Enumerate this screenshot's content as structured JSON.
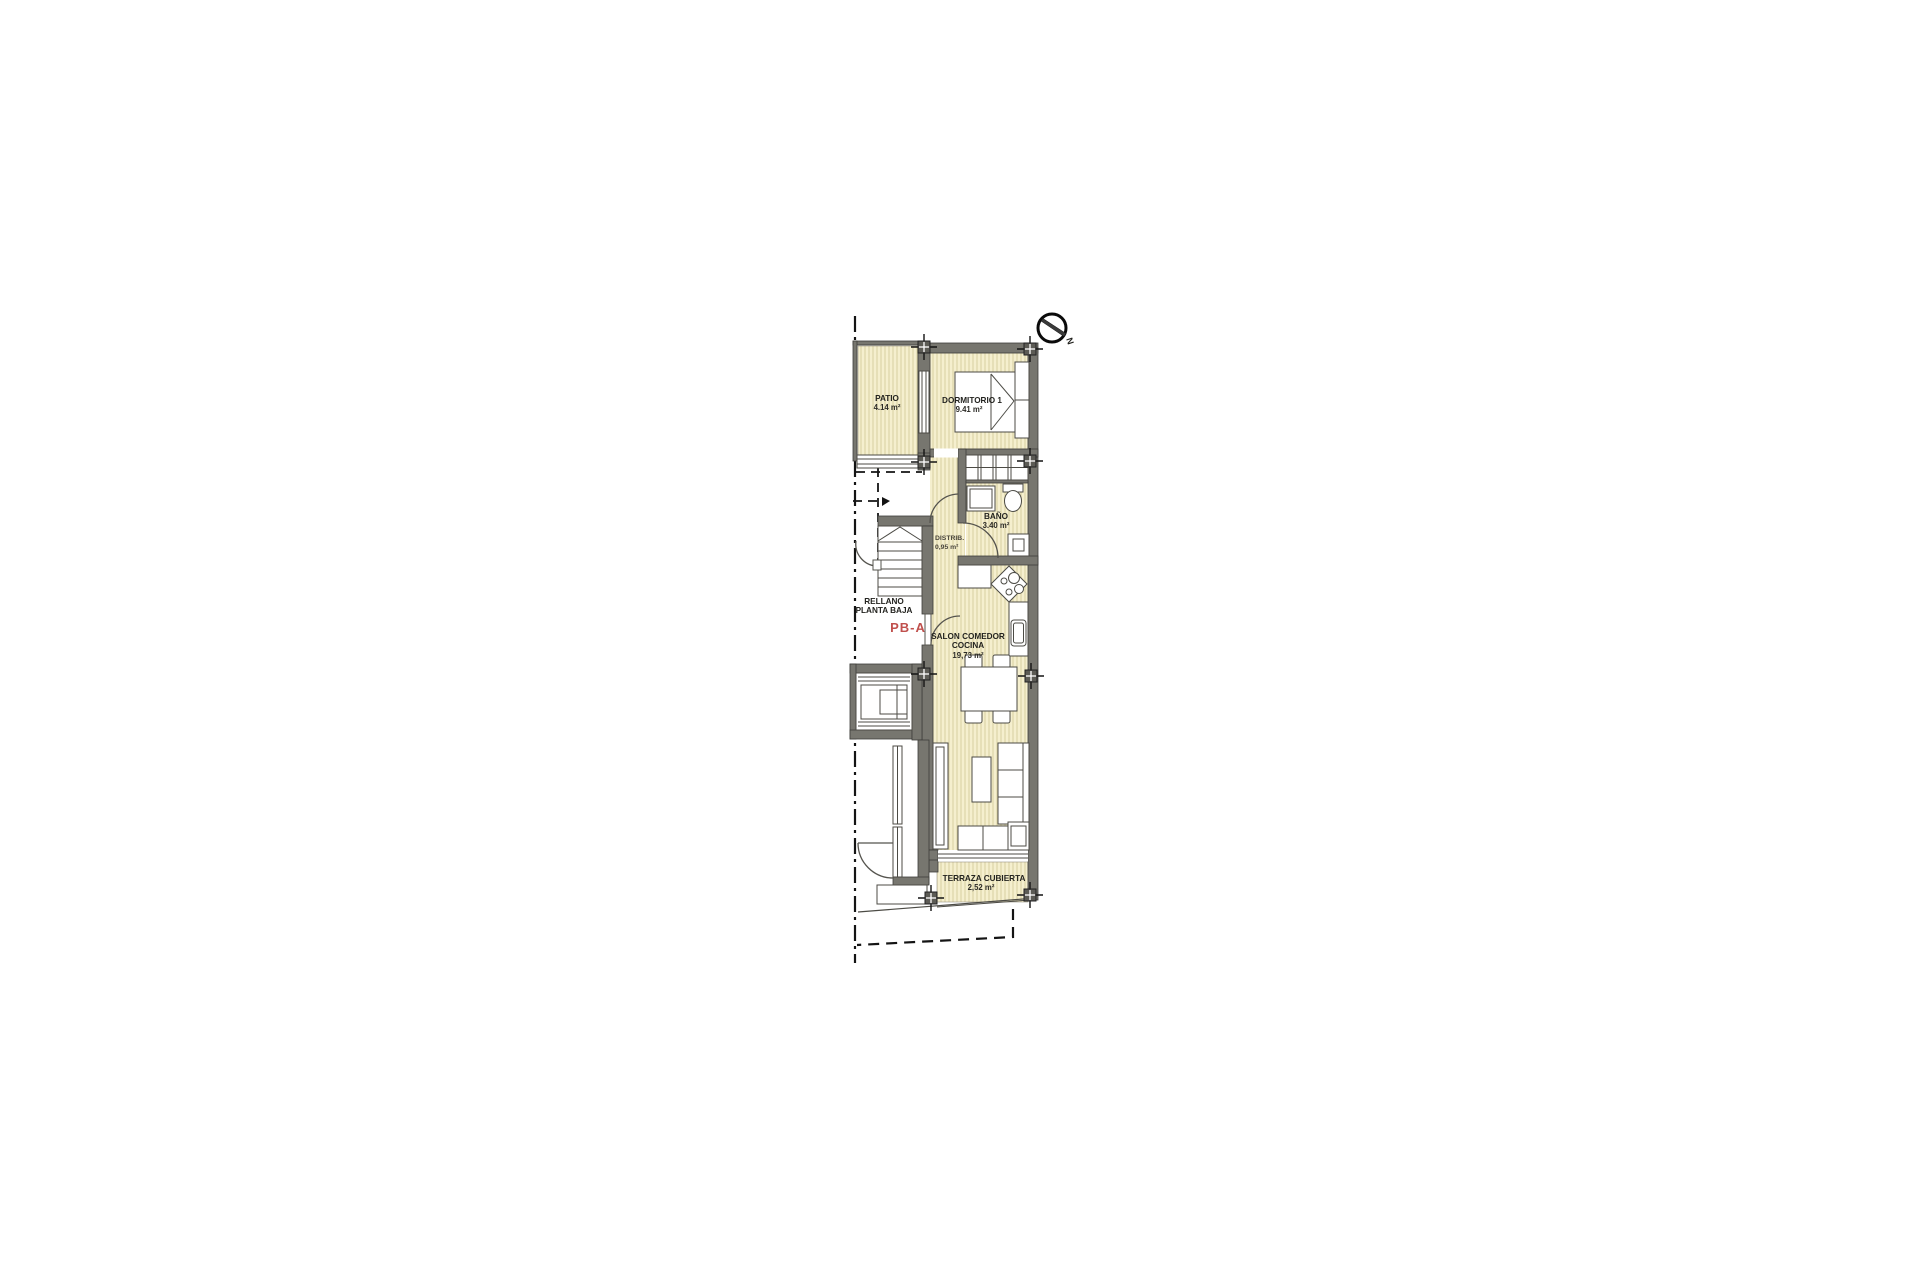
{
  "plan": {
    "kind": "ground-floor apartment plan",
    "unit": {
      "code": "PB-A"
    },
    "compass": {
      "north_label": "N"
    },
    "rooms": {
      "patio": {
        "name": "PATIO",
        "area": "4.14 m²"
      },
      "dormitorio1": {
        "name": "DORMITORIO 1",
        "area": "9.41 m²"
      },
      "bano": {
        "name": "BAÑO",
        "area": "3.40 m²"
      },
      "distribuidor": {
        "name": "DISTRIB.",
        "area": "0,95 m²"
      },
      "rellano": {
        "line1": "RELLANO",
        "line2": "PLANTA BAJA"
      },
      "salon": {
        "line1": "SALON COMEDOR",
        "line2": "COCINA",
        "area": "19,73 m²"
      },
      "terraza": {
        "name": "TERRAZA CUBIERTA",
        "area": "2,52 m²"
      }
    },
    "colors": {
      "room_fill": "#f5efce",
      "hatch_line": "#dbd2a4",
      "wall": "#77766f",
      "unit_label": "#c0504d"
    }
  }
}
